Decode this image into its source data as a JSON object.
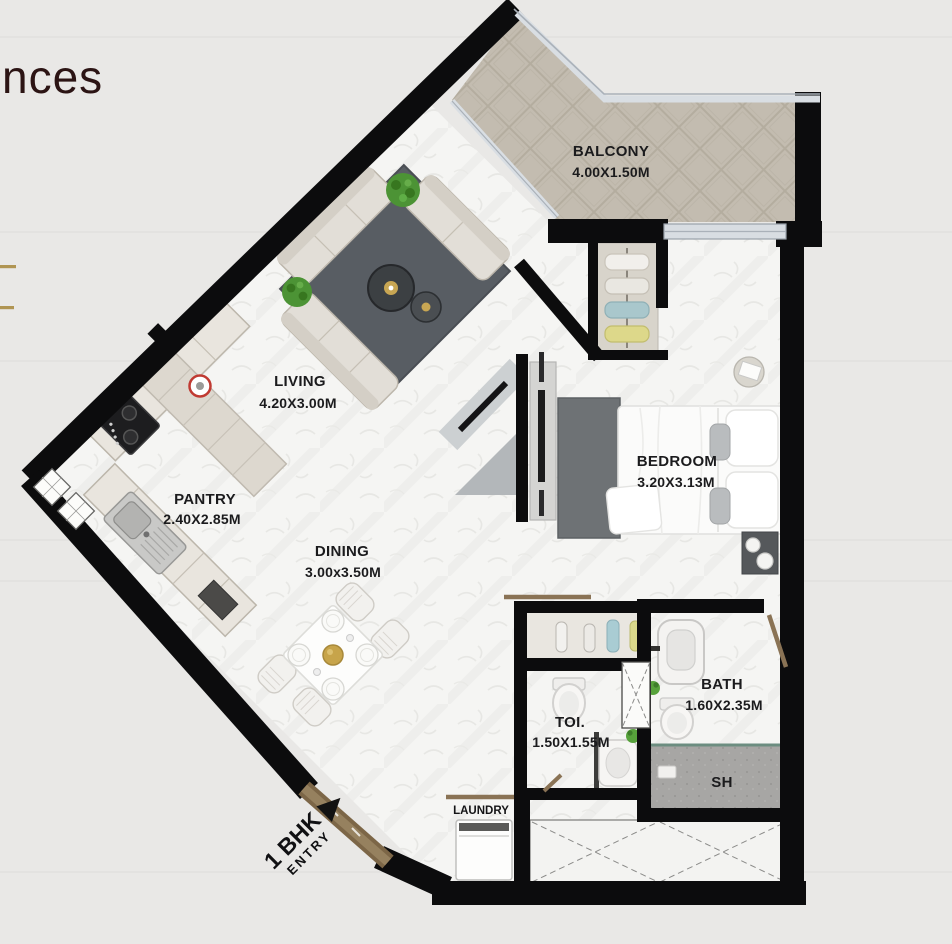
{
  "page": {
    "background": "#e9e8e6"
  },
  "brand": {
    "partial_text": "nces"
  },
  "plan": {
    "rooms": {
      "balcony": {
        "name": "BALCONY",
        "dims": "4.00X1.50M"
      },
      "living": {
        "name": "LIVING",
        "dims": "4.20X3.00M"
      },
      "pantry": {
        "name": "PANTRY",
        "dims": "2.40X2.85M"
      },
      "dining": {
        "name": "DINING",
        "dims": "3.00x3.50M"
      },
      "bedroom": {
        "name": "BEDROOM",
        "dims": "3.20X3.13M"
      },
      "bath": {
        "name": "BATH",
        "dims": "1.60X2.35M"
      },
      "toilet": {
        "name": "TOI.",
        "dims": "1.50X1.55M"
      },
      "shower": {
        "name": "SH"
      },
      "laundry": {
        "name": "LAUNDRY"
      }
    },
    "entry": {
      "unit_type": "1 BHK",
      "label": "ENTRY"
    },
    "colors": {
      "wall": "#0c0c0d",
      "floor": "#f5f5f3",
      "balcony_floor": "#c3bcb0",
      "rug": "#585d63",
      "bedroom_rug": "#6e7275",
      "door": "#8a7355",
      "glass": "#d8dde2",
      "shower_floor": "#a7a6a4",
      "accent_gold": "#b09553",
      "label": "#1b1b1d"
    }
  }
}
